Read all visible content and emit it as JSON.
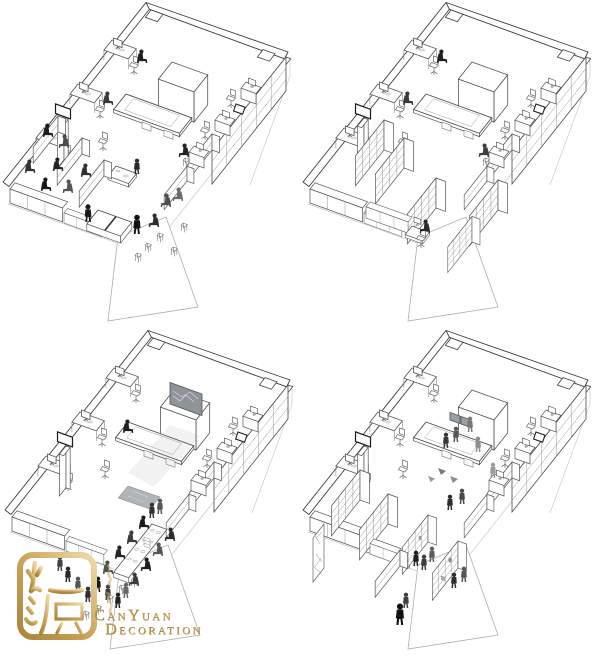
{
  "colors": {
    "background": "#ffffff",
    "line": "#3e3e3e",
    "line_light": "#9a9a9a",
    "wall_hint": "#c9c9c9",
    "glass_mullion": "#8a8a8a",
    "screen_grey": "#8e949a",
    "beam_grey": "#9a9a9a",
    "people_dark": "#1e1e1e",
    "people_mid": "#454545",
    "people_light": "#7b7b7b",
    "gold": "#c2964a",
    "gold_dark": "#a9843c",
    "gold_light": "#e8d5a2"
  },
  "panels": [
    {
      "name": "office-axonometric-top-left",
      "scene": "team-activity-pingpong-and-tiered-seating",
      "figures": 16
    },
    {
      "name": "office-axonometric-top-right",
      "scene": "daily-work-with-bookshelf-partitions",
      "figures": 4
    },
    {
      "name": "office-axonometric-bottom-left",
      "scene": "event-banquet-with-projection-screen",
      "figures": 19
    },
    {
      "name": "office-axonometric-bottom-right",
      "scene": "exhibition-open-house-visitors",
      "figures": 14
    }
  ],
  "watermark": {
    "seal_characters": "灿源",
    "brand_full": "CANYUAN DECORATION",
    "brand": {
      "l1a": "C",
      "l1b": "AN",
      "l1c": "Y",
      "l1d": "UAN",
      "l2a": "D",
      "l2b": "ECORATION"
    }
  }
}
